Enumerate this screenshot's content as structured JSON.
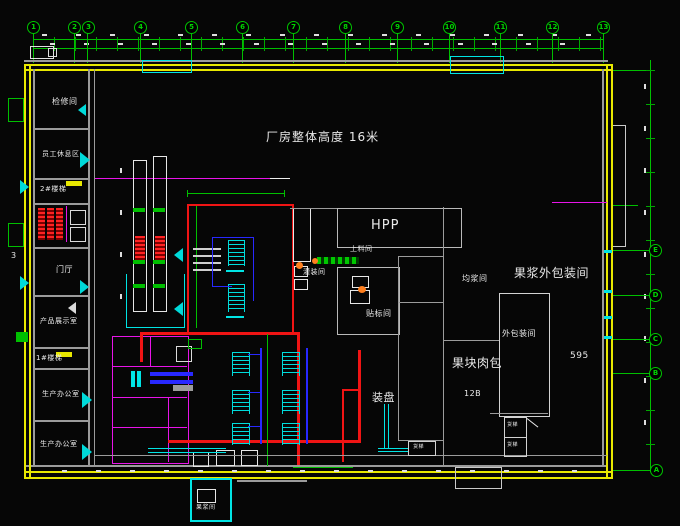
{
  "notes": {
    "height_note": "厂房整体高度 16米",
    "dim_595": "595",
    "section_3": "3"
  },
  "grid": {
    "top": [
      "1",
      "2",
      "3",
      "4",
      "5",
      "6",
      "7",
      "8",
      "9",
      "10",
      "11",
      "12",
      "13"
    ],
    "right": [
      "E",
      "D",
      "C",
      "B",
      "A"
    ]
  },
  "left_rooms": [
    {
      "label": "检修间"
    },
    {
      "label": "员工休息区"
    },
    {
      "label": "2#楼梯"
    },
    {
      "label": "门厅"
    },
    {
      "label": "产品展示室"
    },
    {
      "label": "1#楼梯"
    },
    {
      "label": "生产办公室"
    },
    {
      "label": "生产办公室"
    }
  ],
  "center_rooms": {
    "hpp": "HPP",
    "feed_room": "上料间",
    "filling_room": "灌装间",
    "labeling_room": "贴标间",
    "tray_area": "装盘",
    "pulp_room": "果浆间"
  },
  "right_rooms": {
    "outer_pack_big": "果浆外包装间",
    "homogenize_room": "均浆间",
    "outer_pack_small": "外包装间",
    "fruit_chunk_pack": "果块肉包",
    "room_no": "12B"
  },
  "elevators": [
    {
      "label": "货梯"
    },
    {
      "label": "货梯"
    },
    {
      "label": "货梯"
    }
  ],
  "colors": {
    "background": "#060606",
    "wall_yellow": "#e8e800",
    "grid_green": "#00bf00",
    "pipe_red": "#f01414",
    "pipe_blue": "#2828ff",
    "partition_magenta": "#e814e8",
    "equipment_cyan": "#00e4e4"
  }
}
